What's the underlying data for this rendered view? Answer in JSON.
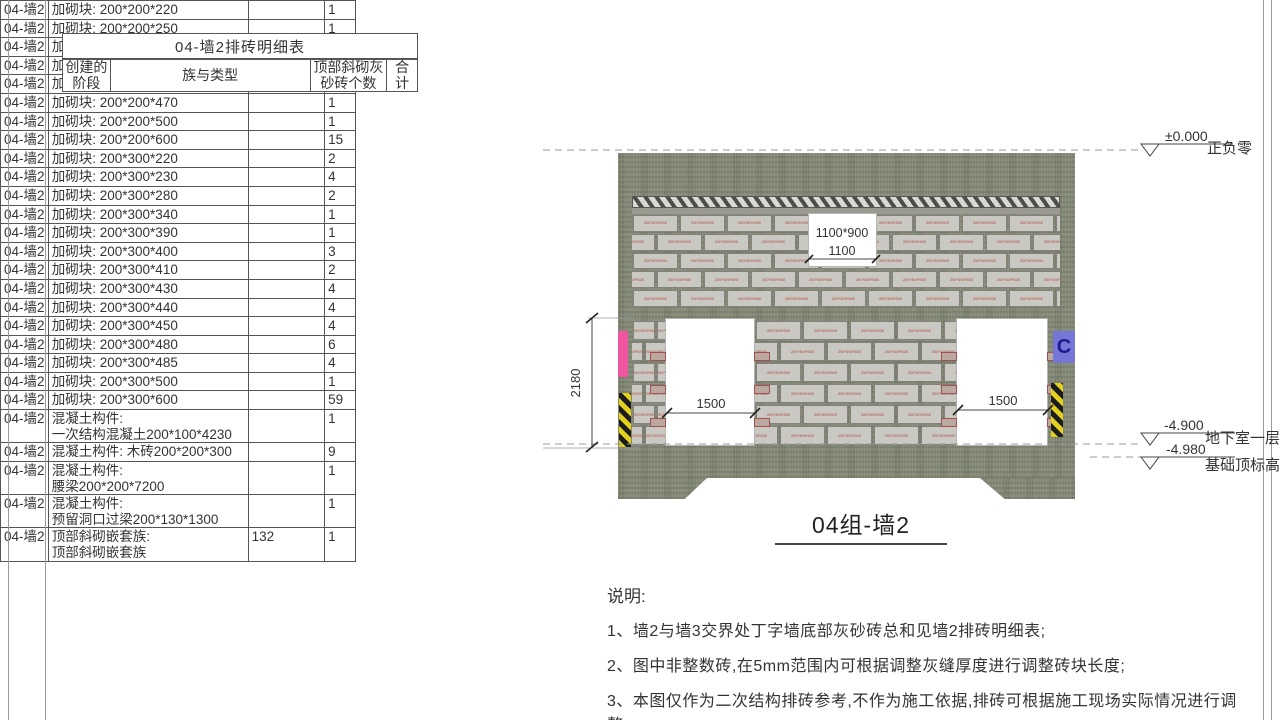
{
  "table": {
    "title": "04-墙2排砖明细表",
    "columns": {
      "phase": "创建的\n阶段",
      "family": "族与类型",
      "count": "顶部斜砌灰\n砂砖个数",
      "total": "合\n计"
    },
    "rows": [
      {
        "phase": "04-墙2",
        "family": [
          "加砌块: 200*200*220"
        ],
        "count": "",
        "total": "1"
      },
      {
        "phase": "04-墙2",
        "family": [
          "加砌块: 200*200*250"
        ],
        "count": "",
        "total": "1"
      },
      {
        "phase": "04-墙2",
        "family": [
          "加砌块: 200*200*300"
        ],
        "count": "",
        "total": "1"
      },
      {
        "phase": "04-墙2",
        "family": [
          "加砌块: 200*200*390"
        ],
        "count": "",
        "total": "1"
      },
      {
        "phase": "04-墙2",
        "family": [
          "加砌块: 200*200*410"
        ],
        "count": "",
        "total": "1"
      },
      {
        "phase": "04-墙2",
        "family": [
          "加砌块: 200*200*470"
        ],
        "count": "",
        "total": "1"
      },
      {
        "phase": "04-墙2",
        "family": [
          "加砌块: 200*200*500"
        ],
        "count": "",
        "total": "1"
      },
      {
        "phase": "04-墙2",
        "family": [
          "加砌块: 200*200*600"
        ],
        "count": "",
        "total": "15"
      },
      {
        "phase": "04-墙2",
        "family": [
          "加砌块: 200*300*220"
        ],
        "count": "",
        "total": "2"
      },
      {
        "phase": "04-墙2",
        "family": [
          "加砌块: 200*300*230"
        ],
        "count": "",
        "total": "4"
      },
      {
        "phase": "04-墙2",
        "family": [
          "加砌块: 200*300*280"
        ],
        "count": "",
        "total": "2"
      },
      {
        "phase": "04-墙2",
        "family": [
          "加砌块: 200*300*340"
        ],
        "count": "",
        "total": "1"
      },
      {
        "phase": "04-墙2",
        "family": [
          "加砌块: 200*300*390"
        ],
        "count": "",
        "total": "1"
      },
      {
        "phase": "04-墙2",
        "family": [
          "加砌块: 200*300*400"
        ],
        "count": "",
        "total": "3"
      },
      {
        "phase": "04-墙2",
        "family": [
          "加砌块: 200*300*410"
        ],
        "count": "",
        "total": "2"
      },
      {
        "phase": "04-墙2",
        "family": [
          "加砌块: 200*300*430"
        ],
        "count": "",
        "total": "4"
      },
      {
        "phase": "04-墙2",
        "family": [
          "加砌块: 200*300*440"
        ],
        "count": "",
        "total": "4"
      },
      {
        "phase": "04-墙2",
        "family": [
          "加砌块: 200*300*450"
        ],
        "count": "",
        "total": "4"
      },
      {
        "phase": "04-墙2",
        "family": [
          "加砌块: 200*300*480"
        ],
        "count": "",
        "total": "6"
      },
      {
        "phase": "04-墙2",
        "family": [
          "加砌块: 200*300*485"
        ],
        "count": "",
        "total": "4"
      },
      {
        "phase": "04-墙2",
        "family": [
          "加砌块: 200*300*500"
        ],
        "count": "",
        "total": "1"
      },
      {
        "phase": "04-墙2",
        "family": [
          "加砌块: 200*300*600"
        ],
        "count": "",
        "total": "59"
      },
      {
        "phase": "04-墙2",
        "family": [
          "混凝土构件:",
          "一次结构混凝土200*100*4230"
        ],
        "count": "",
        "total": "1"
      },
      {
        "phase": "04-墙2",
        "family": [
          "混凝土构件: 木砖200*200*300"
        ],
        "count": "",
        "total": "9"
      },
      {
        "phase": "04-墙2",
        "family": [
          "混凝土构件:",
          "腰梁200*200*7200"
        ],
        "count": "",
        "total": "1"
      },
      {
        "phase": "04-墙2",
        "family": [
          "混凝土构件:",
          "预留洞口过梁200*130*1300"
        ],
        "count": "",
        "total": "1"
      },
      {
        "phase": "04-墙2",
        "family": [
          "顶部斜砌嵌套族:",
          "顶部斜砌嵌套族"
        ],
        "count": "132",
        "total": "1"
      }
    ]
  },
  "drawing": {
    "title": "04组-墙2",
    "levels": [
      {
        "value": "±0.000",
        "label": "正负零"
      },
      {
        "value": "-4.900",
        "label": "地下室一层"
      },
      {
        "value": "-4.980",
        "label": "基础顶标高"
      }
    ],
    "dims": {
      "wall_height": "2180",
      "top_opening_size": "1100*900",
      "top_opening_width": "1100",
      "door1_width": "1500",
      "door2_width": "1500"
    },
    "brick_label": "200*300*600",
    "marker_c": "C",
    "colors": {
      "wall_concrete": "#868b79",
      "brick": "#c9c8c3",
      "brick_label_red": "#b04438",
      "pink_marker": "#f0559f",
      "blue_marker": "#7577d6",
      "stripe_yellow": "#e3cf1d"
    }
  },
  "notes": {
    "heading": "说明:",
    "items": [
      "1、墙2与墙3交界处丁字墙底部灰砂砖总和见墙2排砖明细表;",
      "2、图中非整数砖,在5mm范围内可根据调整灰缝厚度进行调整砖块长度;",
      "3、本图仅作为二次结构排砖参考,不作为施工依据,排砖可根据施工现场实际情况进行调整。"
    ]
  }
}
